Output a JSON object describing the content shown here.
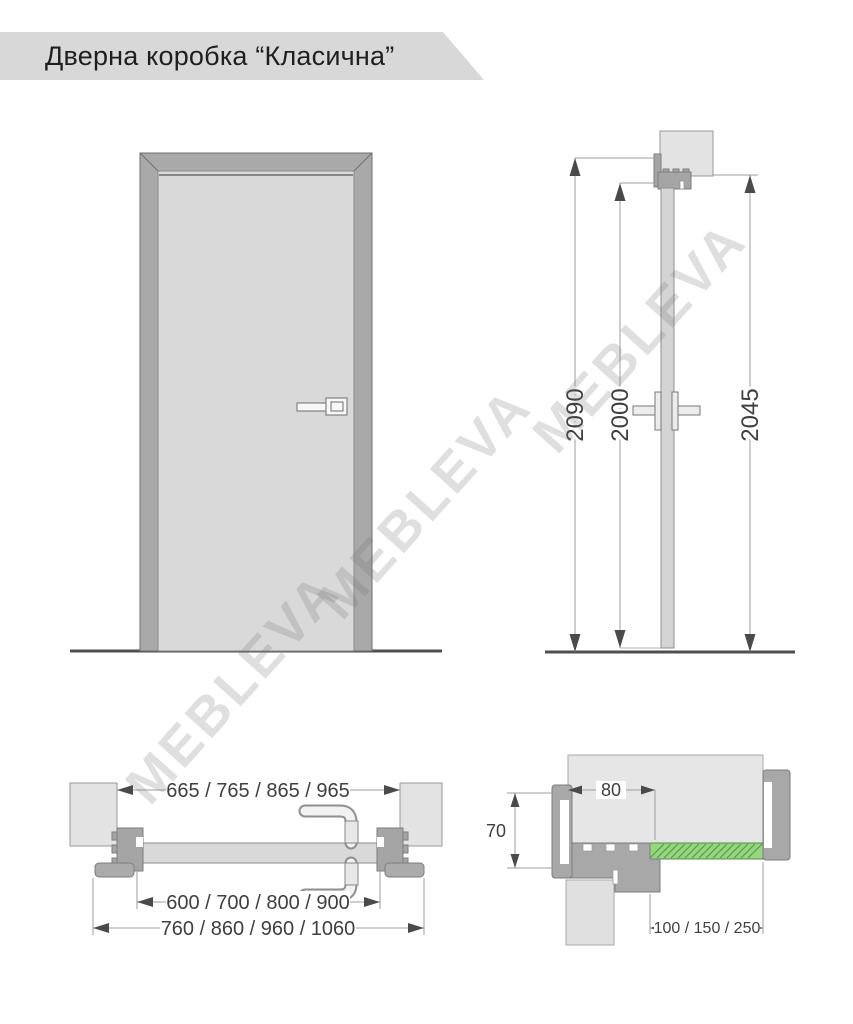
{
  "header": {
    "title": "Дверна коробка “Класична”"
  },
  "watermark": {
    "text": "MEBLEVA"
  },
  "side_view": {
    "height_overall": "2090",
    "height_leaf": "2000",
    "height_frame": "2045"
  },
  "plan_view": {
    "width_frame_inner": "665 / 765 / 865 / 965",
    "width_leaf": "600 / 700 / 800 / 900",
    "width_overall": "760 / 860 / 960 / 1060"
  },
  "detail_view": {
    "frame_depth": "80",
    "frame_thickness": "70",
    "extension_widths": "100 / 150 / 250"
  },
  "colors": {
    "banner": "#d8d8d8",
    "frame_gray": "#a9a9a9",
    "leaf_gray": "#d9d9d9",
    "wall_gray": "#e4e4e4",
    "extension_green": "#97d581",
    "hatch_green": "#569b4a",
    "dim_line": "#9c9c9c",
    "arrow": "#4a4a4a",
    "dim_text": "#3f3f3f"
  }
}
